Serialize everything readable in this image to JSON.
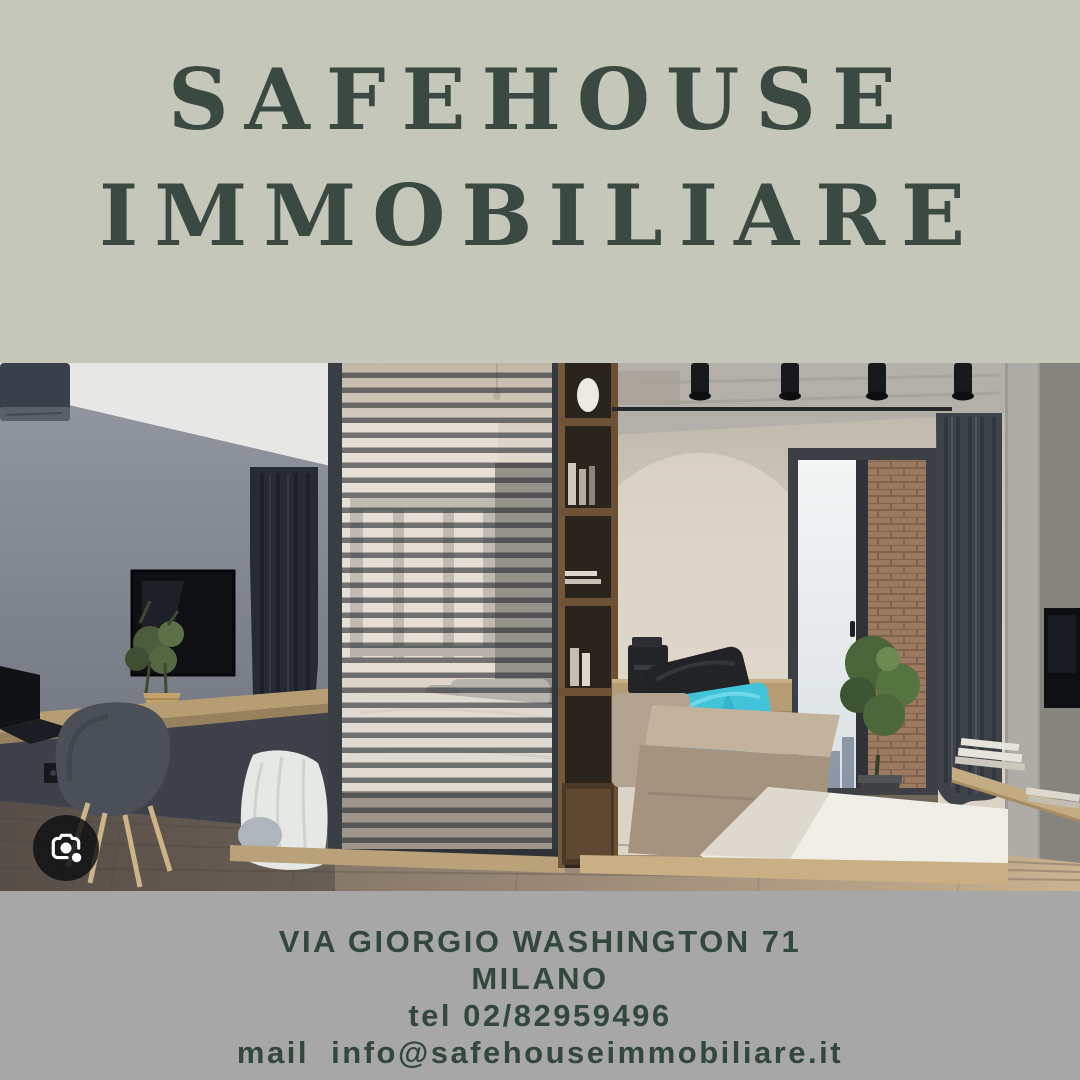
{
  "header": {
    "line1": "SAFEHOUSE",
    "line2": "IMMOBILIARE"
  },
  "photo": {
    "label": "apartment-interior-photo"
  },
  "lens": {
    "icon": "google-lens-camera"
  },
  "footer": {
    "lines": [
      "VIA GIORGIO WASHINGTON 71",
      "MILANO",
      "tel 02/82959496",
      "mail  info@safehouseimmobiliare.it"
    ]
  },
  "colors": {
    "header_bg": "#c6c7bb",
    "footer_bg": "#a7a7a7",
    "title_green": "#3a4a40",
    "footer_green": "#33483d",
    "pillow_cyan": "#41c4da"
  }
}
